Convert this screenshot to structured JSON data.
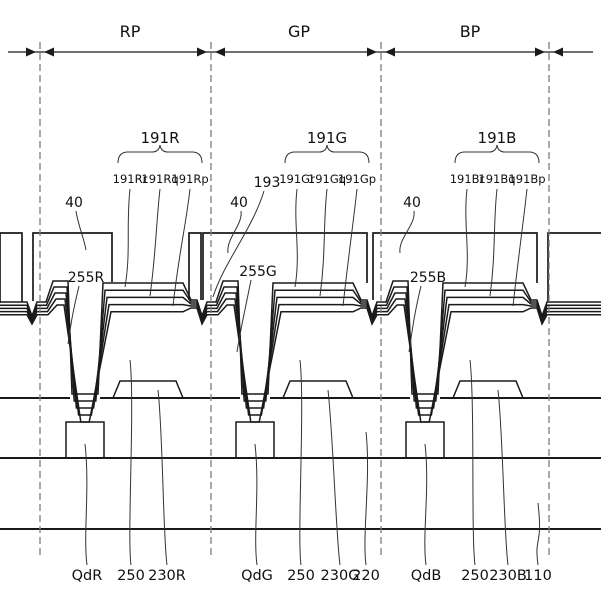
{
  "figure": {
    "type": "patent-cross-section-diagram",
    "pixel_regions": [
      "RP",
      "GP",
      "BP"
    ],
    "electrode_groups": [
      {
        "group": "191R",
        "sub": [
          "191Rr",
          "191Rq",
          "191Rp"
        ]
      },
      {
        "group": "191G",
        "sub": [
          "191Gr",
          "191Gq",
          "191Gp"
        ]
      },
      {
        "group": "191B",
        "sub": [
          "191Br",
          "191Bq",
          "191Bp"
        ]
      }
    ],
    "bank_labels": [
      "40",
      "40",
      "40"
    ],
    "layer_193_label": "193",
    "spacer_labels": [
      "255R",
      "255G",
      "255B"
    ],
    "bottom_labels": [
      "QdR",
      "250",
      "230R",
      "QdG",
      "250",
      "230G",
      "220",
      "QdB",
      "250",
      "230B",
      "110"
    ],
    "line_color": "#1a1a1a"
  }
}
